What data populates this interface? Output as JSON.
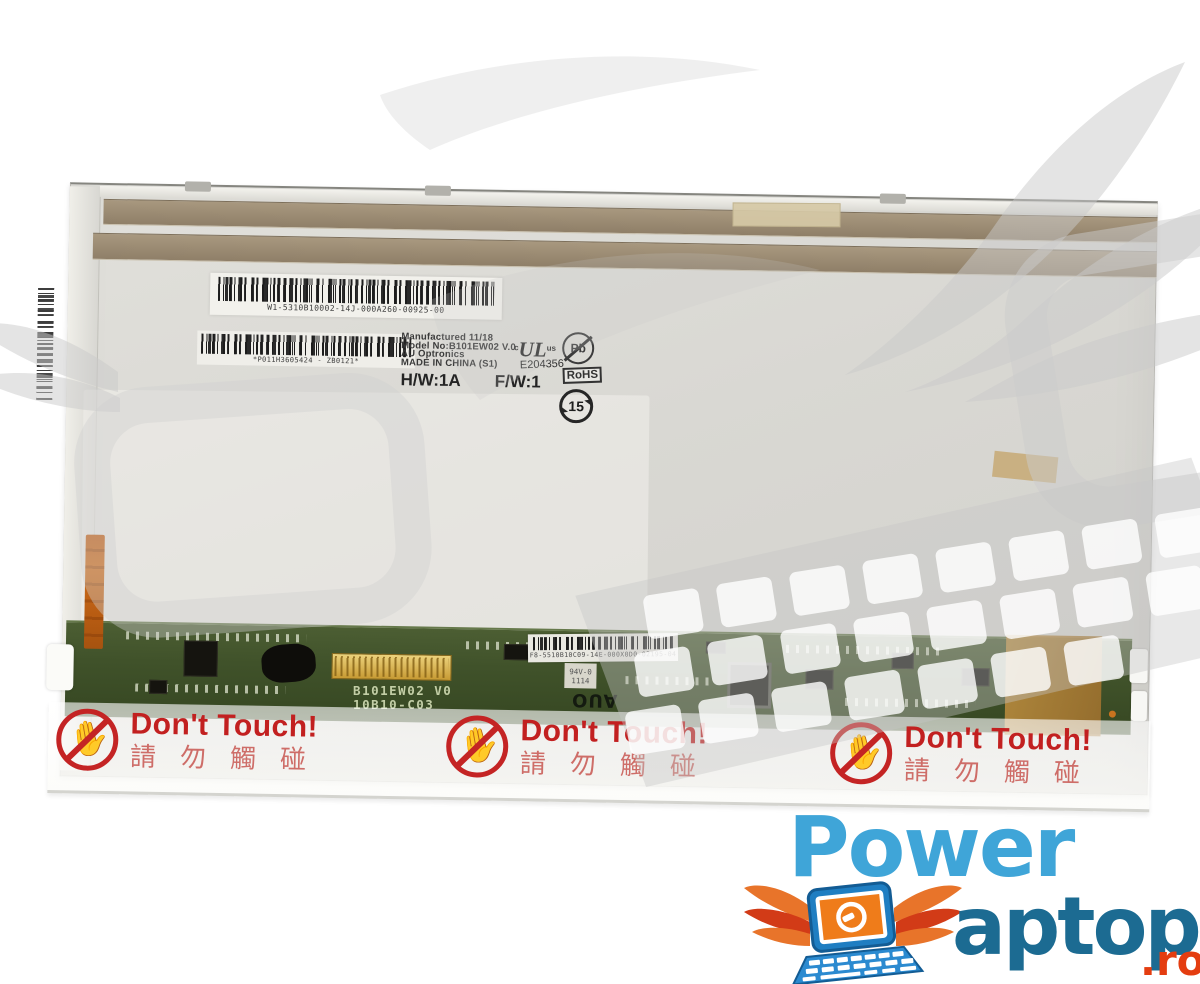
{
  "panel": {
    "top_barcode_text": "W1-5310B10002-14J-000A260-00925-00",
    "spec_label": {
      "line1": "Manufactured 11/18",
      "line2": "Model No:B101EW02  V.0",
      "line3": "AU Optronics",
      "line4": "MADE IN CHINA (S1)",
      "hw": "H/W:1A",
      "fw": "F/W:1",
      "barcode_text": "*P011H3605424 - ZB0121*",
      "ul_prefix": "c",
      "ul_mark": "UL",
      "ul_suffix": "us",
      "ul_file_number": "E204356",
      "pb_symbol": "Pb",
      "rohs": "RoHS",
      "epup_years": "15"
    }
  },
  "pcb": {
    "silkscreen_model": "B101EW02 V0",
    "silkscreen_rev": "10B10-C03",
    "barcode_label_text": "F8-5510B10C09-14E-000X0D0-02195-04",
    "auo_logo_text": "AUO",
    "ic_marking_line1": "94V-0",
    "ic_marking_line2": "1114"
  },
  "warning_film": {
    "labels": [
      {
        "title": "Don't Touch!",
        "subtitle": "請勿觸碰"
      },
      {
        "title": "Don't Touch!",
        "subtitle": "請勿觸碰"
      },
      {
        "title": "Don't Touch!",
        "subtitle": "請勿觸碰"
      }
    ]
  },
  "brand": {
    "word1": "Power",
    "word2": "aptop",
    "tld": ".ro"
  },
  "icons": {
    "no_touch_hand": "✋",
    "brand_icon": "winged laptop with power plug",
    "watermark": "gray wings, ring and keyboard"
  },
  "colors": {
    "warning_red": "#c42424",
    "warning_red_light": "#ce6d68",
    "pcb_green": "#40522a",
    "tape_brown": "#9a8a72",
    "kapton_tan": "#b98d3f",
    "panel_gray": "#d9d8d3",
    "brand_light_blue": "#3fa5d8",
    "brand_dark_blue": "#1c6b92",
    "brand_red": "#e43d10"
  }
}
